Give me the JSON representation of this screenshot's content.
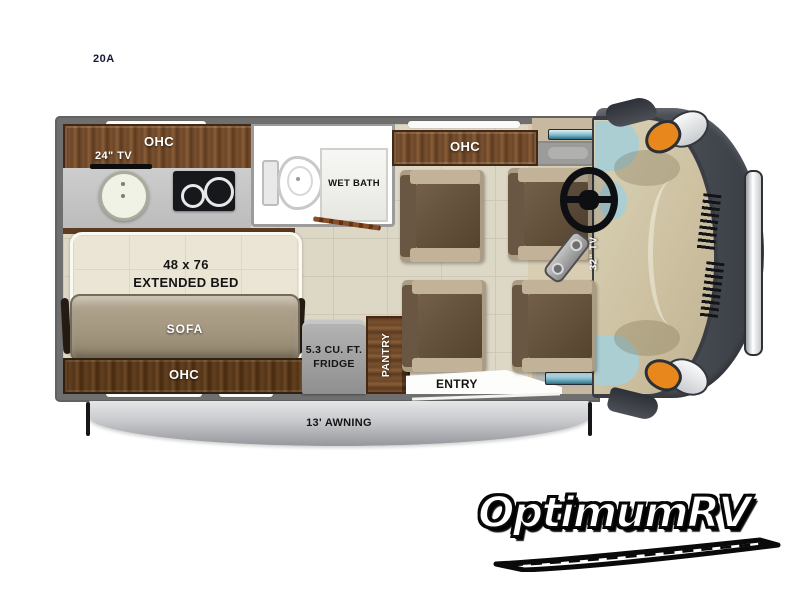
{
  "model": "20A",
  "floorplan": {
    "ohc_front_left": "OHC",
    "tv_front": "24\" TV",
    "wet_bath": "WET BATH",
    "ohc_front_right": "OHC",
    "bed_dims": "48 x 76",
    "bed_type": "EXTENDED BED",
    "sofa": "SOFA",
    "ohc_rear": "OHC",
    "fridge_line1": "5.3 CU. FT.",
    "fridge_line2": "FRIDGE",
    "pantry": "PANTRY",
    "entry": "ENTRY",
    "tv_cab": "32\" TV",
    "awning": "13' AWNING"
  },
  "branding": {
    "dealer": "OptimumRV"
  },
  "colors": {
    "wall": "#6f6f6f",
    "floor": "#ddd7c6",
    "wood": "#6b4628",
    "counter": "#c5c5c5",
    "bed": "#eae5d4",
    "sofa": "#a2957e",
    "fridge": "#9f9f9f",
    "awning": "#c7c9cc",
    "cab_body": "#474b52",
    "windshield": "#cdc1a1",
    "glass": "#abced3",
    "headlight": "#e8871c"
  }
}
